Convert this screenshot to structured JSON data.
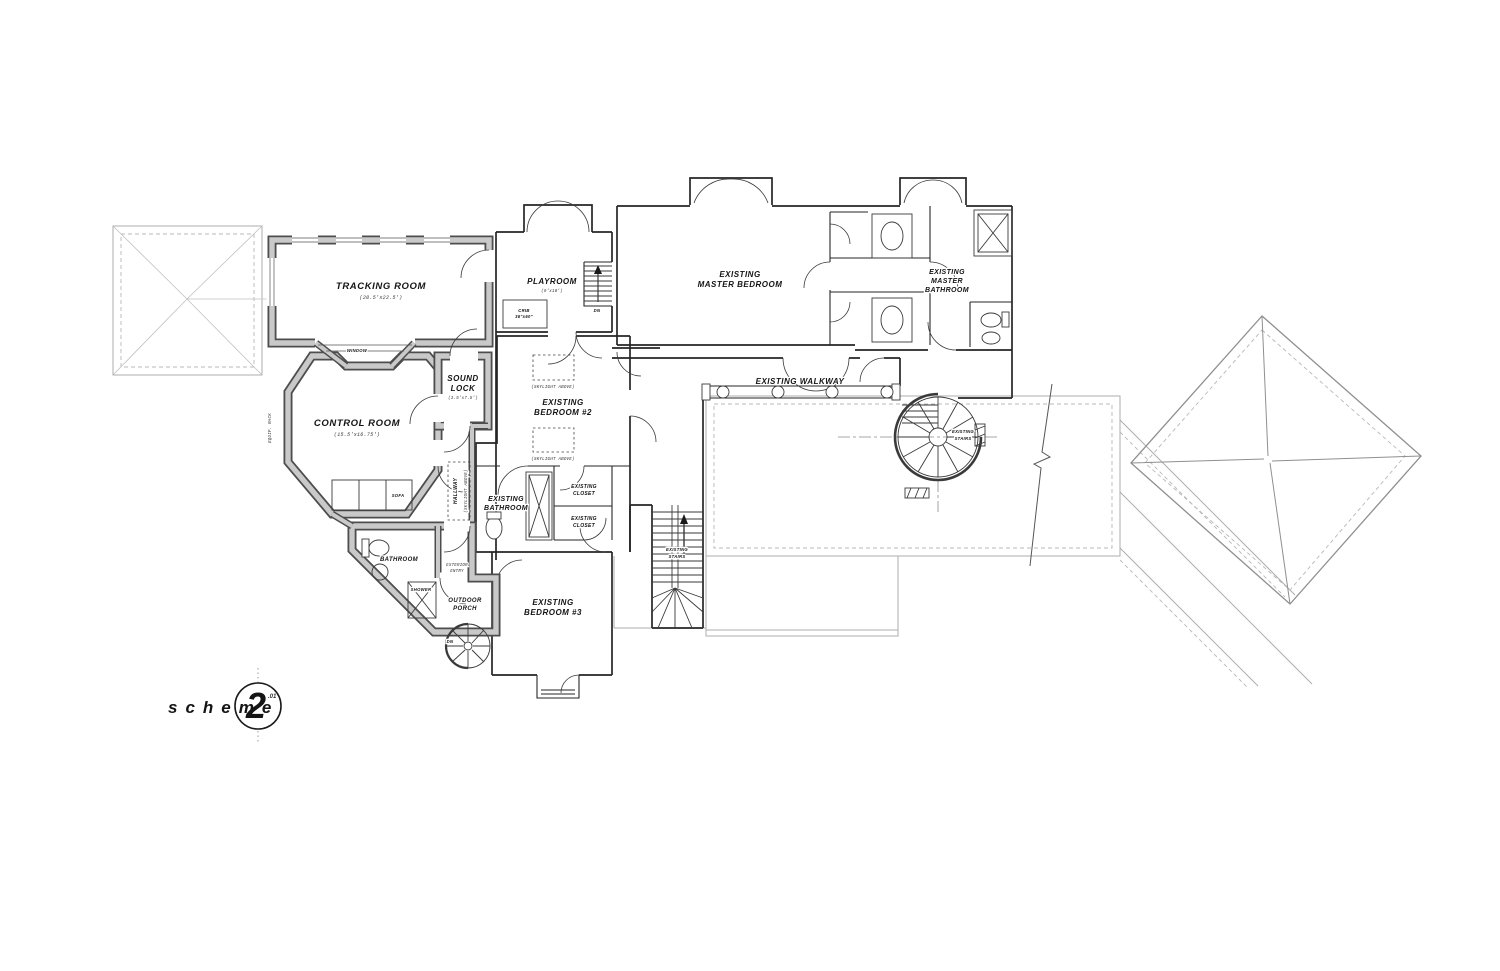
{
  "title": {
    "scheme": "scheme",
    "number": "2",
    "suffix": ".01"
  },
  "rooms": {
    "tracking": {
      "name": "TRACKING ROOM",
      "dims": "(20.5'x22.5')"
    },
    "control": {
      "name": "CONTROL ROOM",
      "dims": "(15.5'x16.75')"
    },
    "sound_lock": {
      "line1": "SOUND",
      "line2": "LOCK",
      "dims": "(3.5'x7.5')"
    },
    "playroom": {
      "name": "PLAYROOM",
      "dims": "(9'x10')"
    },
    "master_bedroom": {
      "line1": "EXISTING",
      "line2": "MASTER BEDROOM"
    },
    "master_bathroom": {
      "line1": "EXISTING",
      "line2": "MASTER",
      "line3": "BATHROOM"
    },
    "bedroom2": {
      "line1": "EXISTING",
      "line2": "BEDROOM #2"
    },
    "bedroom3": {
      "line1": "EXISTING",
      "line2": "BEDROOM #3"
    },
    "existing_bathroom": {
      "line1": "EXISTING",
      "line2": "BATHROOM"
    },
    "closet": {
      "line1": "EXISTING",
      "line2": "CLOSET"
    },
    "walkway": {
      "name": "EXISTING WALKWAY"
    },
    "studio_bathroom": {
      "name": "BATHROOM"
    },
    "outdoor_porch": {
      "line1": "OUTDOOR",
      "line2": "PORCH"
    },
    "hallway": {
      "name": "HALLWAY",
      "note": "(SKYLIGHT ABOVE)"
    }
  },
  "annotations": {
    "window": "WINDOW",
    "sofa": "SOFA",
    "shower": "SHOWER",
    "equip_rack": "EQUIP. RACK",
    "crib_line1": "CRIB",
    "crib_line2": "36\"x60\"",
    "skylight": "(SKYLIGHT ABOVE)",
    "exterior_entry_line1": "EXTERIOR",
    "exterior_entry_line2": "ENTRY",
    "stairs_line1": "EXISTING",
    "stairs_line2": "STAIRS",
    "dn": "DN"
  },
  "colors": {
    "background": "#ffffff",
    "existing_wall": "#262626",
    "new_wall_fill": "#c9c9c9",
    "new_wall_edge": "#4d4d4d",
    "roof_outline": "#aeaeae",
    "text": "#141414"
  }
}
